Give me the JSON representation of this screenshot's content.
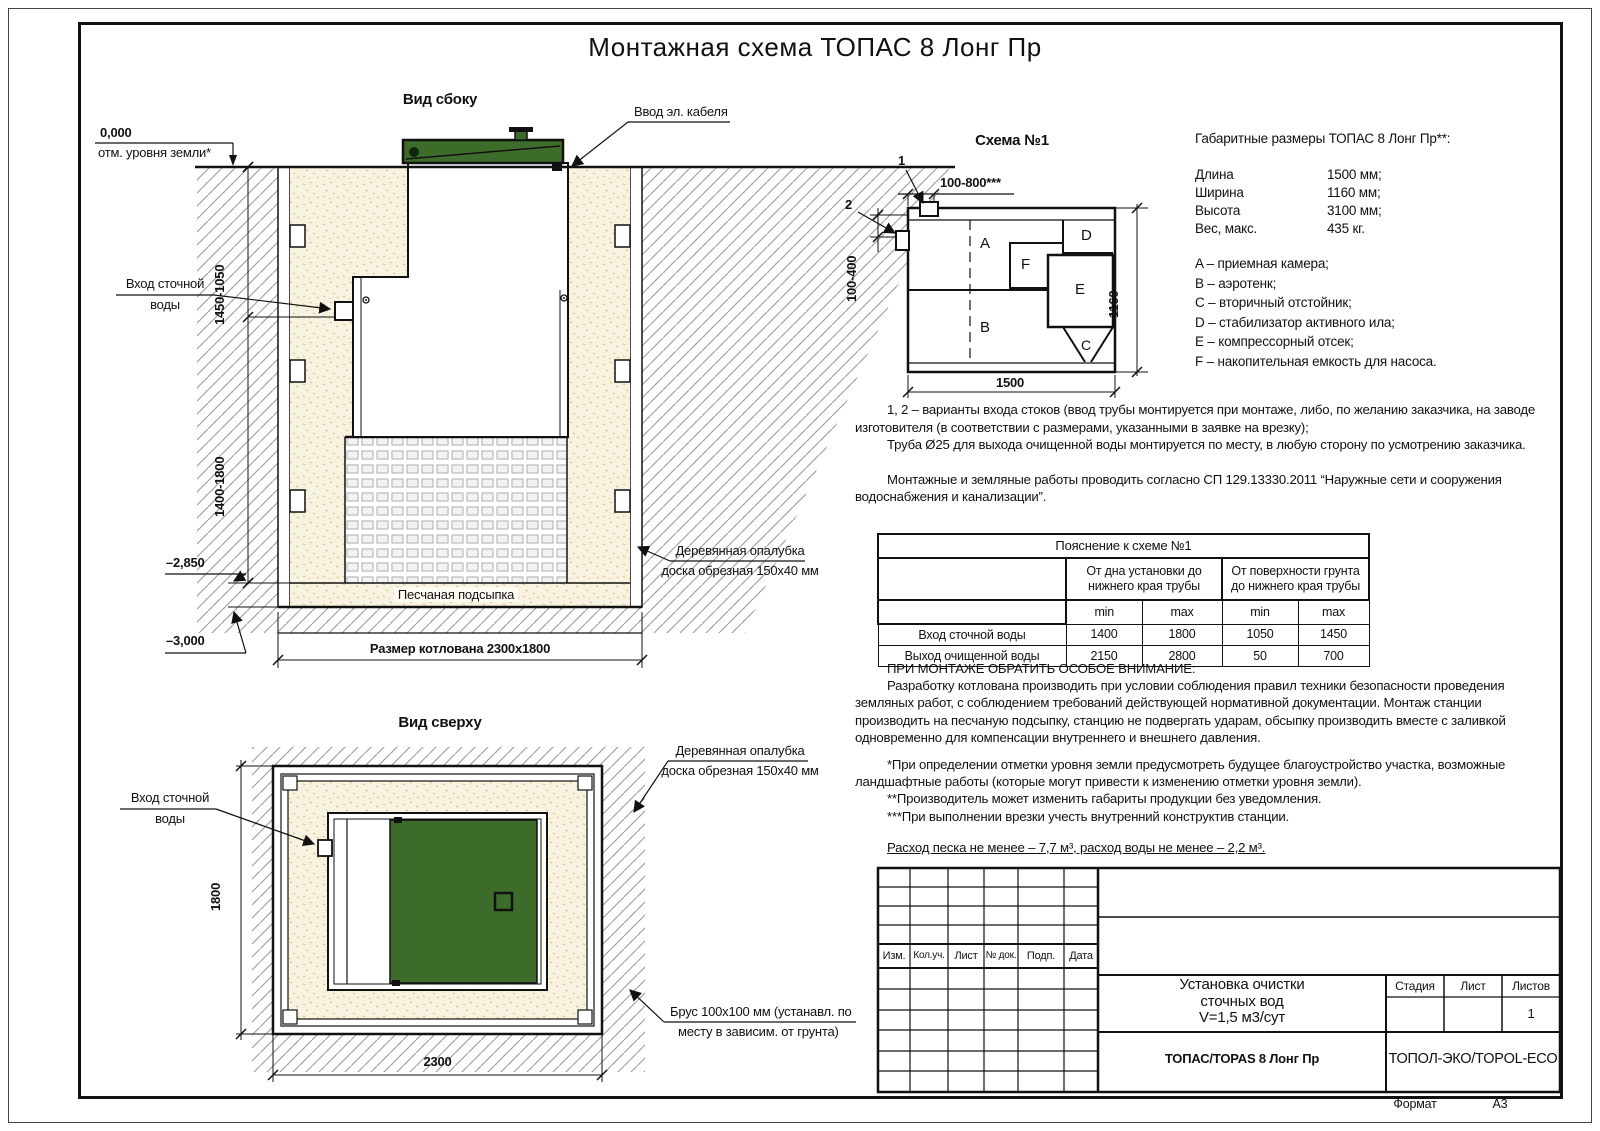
{
  "page": {
    "title": "Монтажная схема ТОПАС 8 Лонг Пр",
    "format_label": "Формат",
    "format_value": "А3"
  },
  "colors": {
    "lid_green": "#3d6c2a",
    "sand": "#f8f3e0",
    "line": "#111111"
  },
  "side_view": {
    "heading": "Вид сбоку",
    "level_zero": "0,000",
    "level_zero_note": "отм. уровня земли*",
    "cable_label": "Ввод эл. кабеля",
    "inlet_line1": "Вход сточной",
    "inlet_line2": "воды",
    "dim_upper": "1450-1050",
    "dim_lower": "1400-1800",
    "level_minus285": "–2,850",
    "level_minus300": "–3,000",
    "sand_label": "Песчаная подсыпка",
    "pit_label": "Размер котлована 2300x1800",
    "formwork_line1": "Деревянная опалубка",
    "formwork_line2": "доска обрезная 150x40 мм"
  },
  "schema": {
    "heading": "Схема №1",
    "marker1": "1",
    "marker2": "2",
    "dim_top": "100-800***",
    "dim_left": "100-400",
    "dim_width": "1500",
    "dim_height": "1160",
    "comp_a": "A",
    "comp_b": "B",
    "comp_c": "C",
    "comp_d": "D",
    "comp_e": "E",
    "comp_f": "F"
  },
  "specs": {
    "heading": "Габаритные размеры ТОПАС 8 Лонг Пр**:",
    "rows": [
      {
        "label": "Длина",
        "value": "1500 мм;"
      },
      {
        "label": "Ширина",
        "value": "1160 мм;"
      },
      {
        "label": "Высота",
        "value": "3100 мм;"
      },
      {
        "label": "Вес, макс.",
        "value": "435 кг."
      }
    ],
    "legend": [
      "A – приемная камера;",
      "B – аэротенк;",
      "C – вторичный отстойник;",
      "D – стабилизатор активного ила;",
      "E – компрессорный отсек;",
      "F – накопительная емкость для насоса."
    ]
  },
  "notes": {
    "p1": "1, 2 – варианты входа  стоков (ввод трубы монтируется при монтаже, либо, по желанию заказчика, на заводе изготовителя (в соответствии с размерами, указанными в заявке на врезку);",
    "p2": "Труба Ø25 для выхода очищенной воды монтируется по месту, в любую сторону по усмотрению заказчика.",
    "p3": "Монтажные и земляные работы проводить согласно СП 129.13330.2011 “Наружные сети и сооружения водоснабжения и канализации”."
  },
  "explain_table": {
    "title": "Пояснение к схеме №1",
    "col1_header": "От дна установки до нижнего края трубы",
    "col2_header": "От поверхности грунта до нижнего края трубы",
    "min_label": "min",
    "max_label": "max",
    "rows": [
      {
        "label": "Вход сточной воды",
        "v1": "1400",
        "v2": "1800",
        "v3": "1050",
        "v4": "1450"
      },
      {
        "label": "Выход очищенной воды",
        "v1": "2150",
        "v2": "2800",
        "v3": "50",
        "v4": "700"
      }
    ]
  },
  "attention": {
    "heading": "ПРИ МОНТАЖЕ ОБРАТИТЬ ОСОБОЕ ВНИМАНИЕ:",
    "p1": "Разработку котлована производить при условии соблюдения правил техники безопасности проведения земляных работ, с соблюдением требований действующей нормативной документации. Монтаж станции производить на песчаную подсыпку, станцию не подвергать ударам, обсыпку производить вместе с заливкой одновременно для компенсации внутреннего и внешнего давления.",
    "fn1": "*При определении отметки уровня земли предусмотреть будущее благоустройство участка, возможные ландшафтные работы (которые могут привести к изменению отметки уровня земли).",
    "fn2": "**Производитель может изменить габариты продукции без уведомления.",
    "fn3": "***При выполнении врезки учесть внутренний конструктив станции.",
    "consumption": "Расход песка не менее – 7,7 м³, расход воды не менее – 2,2 м³."
  },
  "top_view": {
    "heading": "Вид сверху",
    "inlet_line1": "Вход сточной",
    "inlet_line2": "воды",
    "dim_height": "1800",
    "dim_width": "2300",
    "formwork_line1": "Деревянная опалубка",
    "formwork_line2": "доска обрезная 150x40 мм",
    "beam_line1": "Брус 100x100 мм (устанавл. по",
    "beam_line2": "месту в зависим. от грунта)"
  },
  "stamp": {
    "rev_headers": [
      "Изм.",
      "Кол.уч.",
      "Лист",
      "№ док.",
      "Подп.",
      "Дата"
    ],
    "title_line1": "Установка очистки",
    "title_line2": "сточных вод",
    "title_line3": "V=1,5 м3/сут",
    "product": "ТОПАС/TOPAS 8 Лонг Пр",
    "company": "ТОПОЛ-ЭКО/TOPOL-ECO",
    "stage_label": "Стадия",
    "sheet_label": "Лист",
    "sheets_label": "Листов",
    "sheets_value": "1"
  }
}
